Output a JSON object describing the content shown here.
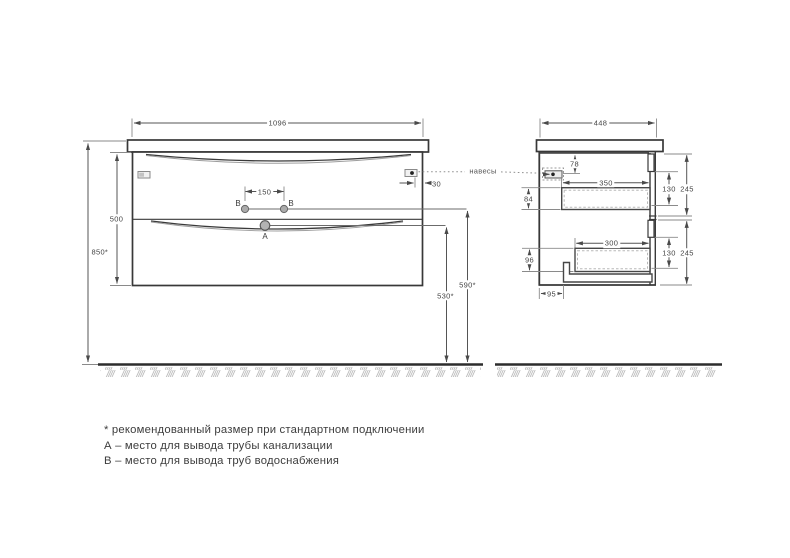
{
  "drawing": {
    "front": {
      "width": "1096",
      "cabinet_height": "500",
      "mount_height": "850*",
      "hole_spacing": "150",
      "hanger_offset": "30",
      "water_supply_height": "590*",
      "drain_height": "530*",
      "point_a_label": "A",
      "point_b_left_label": "B",
      "point_b_right_label": "B",
      "hangers_label": "навесы"
    },
    "side": {
      "depth": "448",
      "hanger_from_top": "78",
      "upper_drawer_depth": "350",
      "upper_drawer_height": "84",
      "upper_front_height": "130",
      "upper_section_height": "245",
      "lower_drawer_depth": "300",
      "lower_drawer_height": "96",
      "lower_front_height": "130",
      "lower_section_height": "245",
      "bottom_back_offset": "95"
    },
    "notes": {
      "asterisk": "* рекомендованный размер при стандартном подключении",
      "a": "А – место для вывода трубы канализации",
      "b": "В – место для вывода труб водоснабжения"
    },
    "colors": {
      "outline": "#383838",
      "dimension": "#555555",
      "hatch": "#bcbcbc",
      "background": "#ffffff"
    }
  }
}
